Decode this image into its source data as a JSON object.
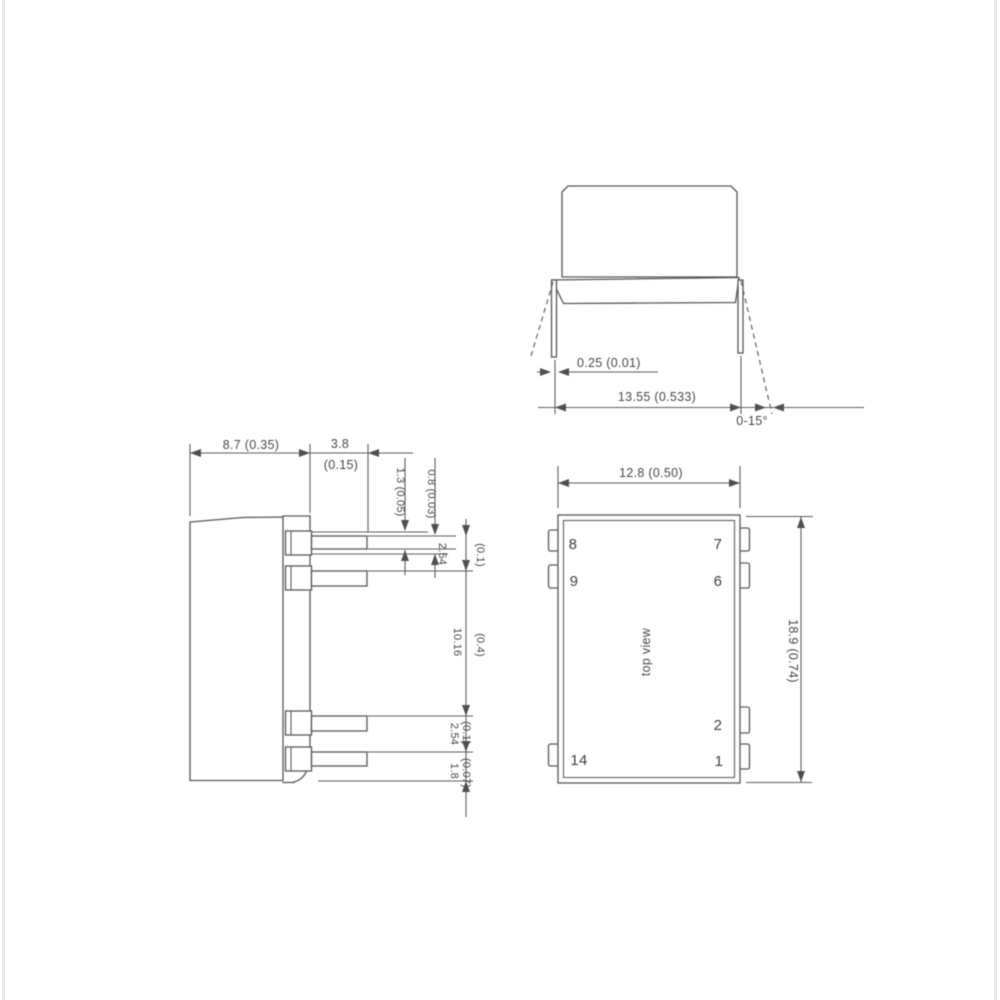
{
  "front_view": {
    "pin_thickness": "0.25 (0.01)",
    "lead_span": "13.55 (0.533)",
    "bend_angle": "0-15°"
  },
  "side_view": {
    "body_depth": "8.7 (0.35)",
    "pin_length_mm": "3.8",
    "pin_length_in": "(0.15)",
    "standoff_a": "1.3 (0.05)",
    "standoff_b": "0.8 (0.03)",
    "pitch_top_mm": "2.54",
    "pitch_top_in": "(0.1)",
    "row_spacing_mm": "10.16",
    "row_spacing_in": "(0.4)",
    "pitch_bottom_mm": "2.54",
    "pitch_bottom_in": "(0.1)",
    "edge_offset_mm": "1.8",
    "edge_offset_in": "(0.07)"
  },
  "top_view": {
    "label": "top view",
    "body_width": "12.8 (0.50)",
    "body_length": "18.9 (0.74)",
    "pins": {
      "top_left_1": "8",
      "top_left_2": "9",
      "top_right_1": "7",
      "top_right_2": "6",
      "bottom_right_1": "2",
      "bottom_right_2": "1",
      "bottom_left": "14"
    }
  },
  "colors": {
    "line": "#575757",
    "text": "#474747",
    "background": "#ffffff"
  }
}
